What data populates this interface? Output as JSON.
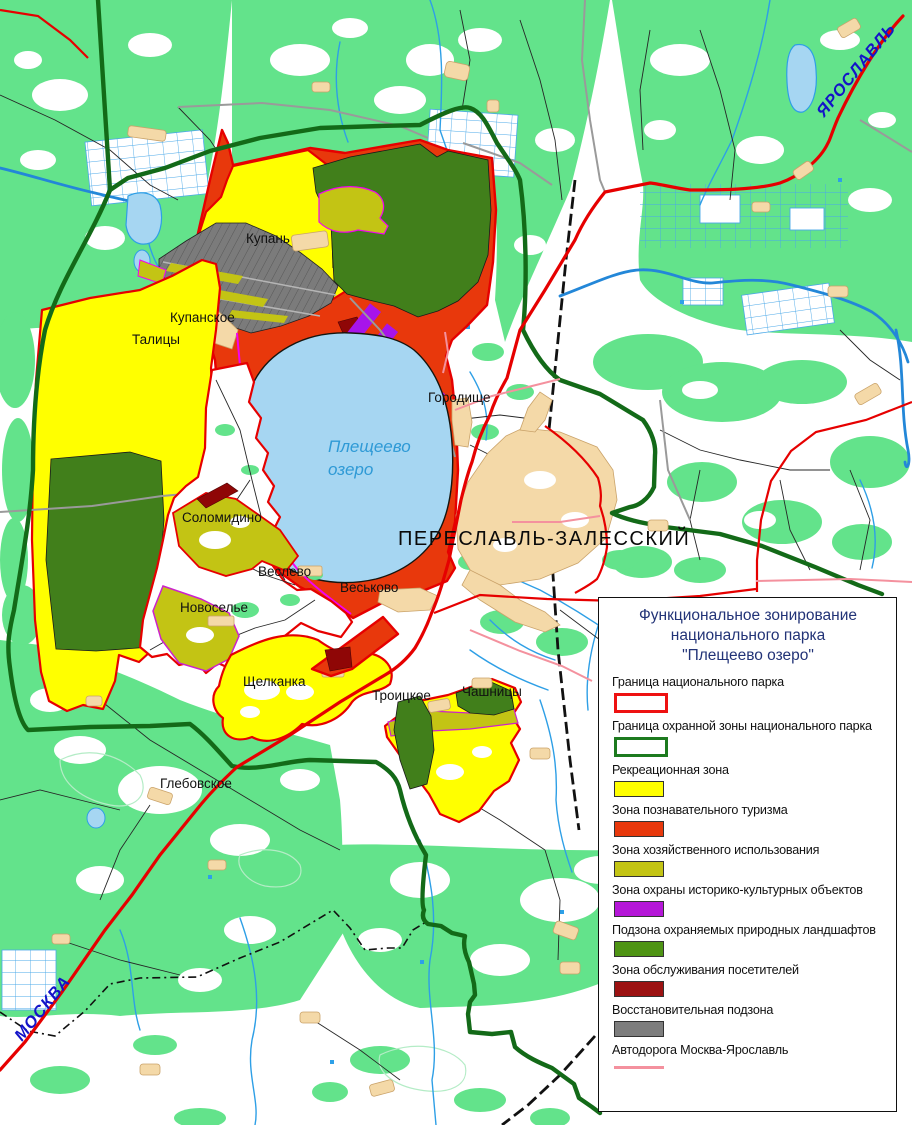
{
  "map": {
    "lake_label_line1": "Плещеево",
    "lake_label_line2": "озеро",
    "city_label": "ПЕРЕСЛАВЛЬ-ЗАЛЕССКИЙ",
    "road_label_top_right": "ЯРОСЛАВЛЬ",
    "road_label_bottom_left": "МОСКВА",
    "settlements": [
      "Купань",
      "Купанское",
      "Талицы",
      "Городище",
      "Соломидино",
      "Веслево",
      "Веськово",
      "Новоселье",
      "Щелканка",
      "Троицкое",
      "Чашницы",
      "Глебовское"
    ]
  },
  "legend": {
    "title_lines": [
      "Функциональное зонирование",
      "национального парка",
      "\"Плещеево озеро\""
    ],
    "items": [
      {
        "label": "Граница национального парка",
        "swatch": "outline",
        "color": "#ee1111"
      },
      {
        "label": "Граница охранной зоны национального парка",
        "swatch": "outline",
        "color": "#1d7a1f"
      },
      {
        "label": "Рекреационная зона",
        "swatch": "fill",
        "color": "#ffff00"
      },
      {
        "label": "Зона познавательного туризма",
        "swatch": "fill",
        "color": "#e8380c"
      },
      {
        "label": "Зона хозяйственного использования",
        "swatch": "fill",
        "color": "#c3c414"
      },
      {
        "label": "Зона охраны историко-культурных объектов",
        "swatch": "fill",
        "color": "#b517d8"
      },
      {
        "label": "Подзона охраняемых природных ландшафтов",
        "swatch": "fill",
        "color": "#4e9414"
      },
      {
        "label": "Зона обслуживания посетителей",
        "swatch": "fill",
        "color": "#9c1212"
      },
      {
        "label": "Восстановительная подзона",
        "swatch": "fill",
        "color": "#7d7d7d"
      },
      {
        "label": "Автодорога Москва-Ярославль",
        "swatch": "line",
        "color": "#f4919e"
      }
    ]
  },
  "colors": {
    "forest": "#63e38b",
    "lake": "#a6d6f2",
    "park_boundary": "#ee1111",
    "buffer_boundary": "#136a18",
    "recreation": "#ffff00",
    "tourism": "#e8380c",
    "economic": "#c3c414",
    "heritage": "#b517d8",
    "landscape": "#4e9414",
    "service": "#9c1212",
    "restoration": "#7d7d7d",
    "highway": "#e60000"
  }
}
